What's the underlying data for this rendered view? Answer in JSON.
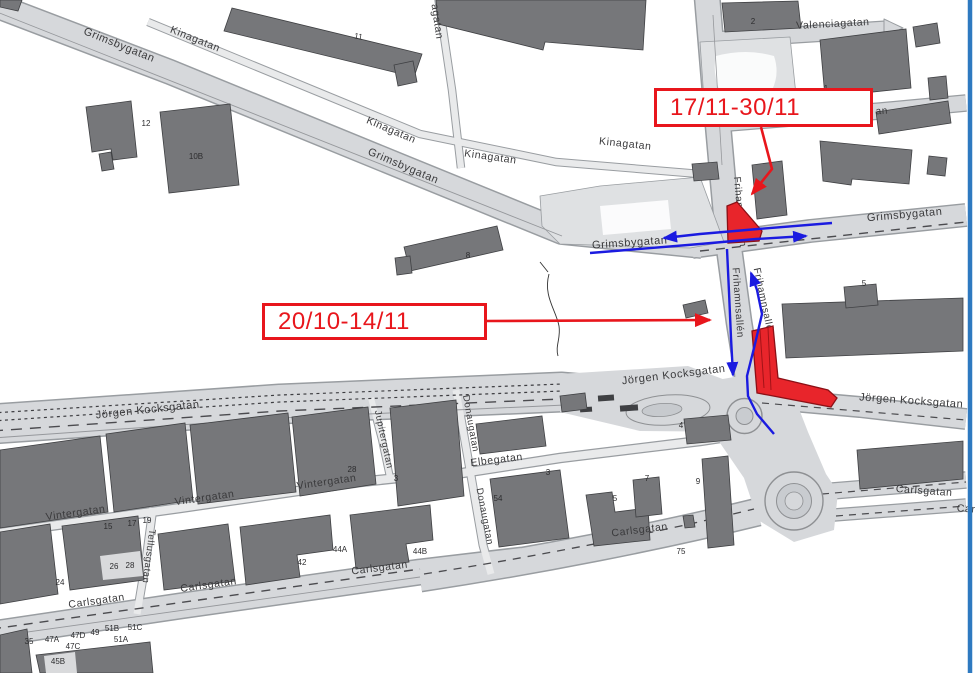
{
  "map": {
    "callouts": [
      {
        "id": "callout-1",
        "label": "17/11-30/11"
      },
      {
        "id": "callout-2",
        "label": "20/10-14/11"
      }
    ],
    "street_labels": [
      {
        "id": "grimsbygatan-nw",
        "text": "Grimsbygatan",
        "x": 118,
        "y": 48,
        "rot": 22,
        "size": 11
      },
      {
        "id": "kinagatan-nw",
        "text": "Kinagatan",
        "x": 194,
        "y": 42,
        "rot": 22,
        "size": 10.5
      },
      {
        "id": "kinagatan-mid",
        "text": "Kinagatan",
        "x": 390,
        "y": 133,
        "rot": 23,
        "size": 10.5
      },
      {
        "id": "grimsbygatan-mid",
        "text": "Grimsbygatan",
        "x": 402,
        "y": 169,
        "rot": 23,
        "size": 11
      },
      {
        "id": "kinagatan-c",
        "text": "Kinagatan",
        "x": 490,
        "y": 160,
        "rot": 8,
        "size": 10.5
      },
      {
        "id": "kinagatan-e",
        "text": "Kinagatan",
        "x": 625,
        "y": 147,
        "rot": 6,
        "size": 10.5
      },
      {
        "id": "valenciagatan",
        "text": "Valenciagatan",
        "x": 833,
        "y": 27,
        "rot": -3,
        "size": 10.5
      },
      {
        "id": "kinagatan-vert",
        "text": "agatan",
        "x": 434,
        "y": 22,
        "rot": 82,
        "size": 10.5
      },
      {
        "id": "grimsbygatan-ctr",
        "text": "Grimsbygatan",
        "x": 630,
        "y": 246,
        "rot": -4,
        "size": 11
      },
      {
        "id": "grimsbygatan-e",
        "text": "Grimsbygatan",
        "x": 905,
        "y": 218,
        "rot": -5,
        "size": 11
      },
      {
        "id": "frihamnsallen-n",
        "text": "Frihamnsallén",
        "x": 737,
        "y": 212,
        "rot": 85,
        "size": 10
      },
      {
        "id": "frihamnsallen-sw",
        "text": "Frihamnsallén",
        "x": 735,
        "y": 303,
        "rot": 86,
        "size": 10
      },
      {
        "id": "frihamnsallen-se",
        "text": "Frihamnsallén",
        "x": 761,
        "y": 303,
        "rot": 78,
        "size": 10
      },
      {
        "id": "jorgen-kocksgatan-w",
        "text": "Jörgen Kocksgatan",
        "x": 148,
        "y": 413,
        "rot": -6,
        "size": 11
      },
      {
        "id": "jorgen-kocksgatan-c",
        "text": "Jörgen Kocksgatan",
        "x": 674,
        "y": 378,
        "rot": -7,
        "size": 11
      },
      {
        "id": "jorgen-kocksgatan-e",
        "text": "Jörgen Kocksgatan",
        "x": 911,
        "y": 404,
        "rot": 4,
        "size": 11
      },
      {
        "id": "vintergatan-w",
        "text": "Vintergatan",
        "x": 76,
        "y": 516,
        "rot": -8,
        "size": 10.5
      },
      {
        "id": "vintergatan-c",
        "text": "Vintergatan",
        "x": 205,
        "y": 501,
        "rot": -8,
        "size": 10.5
      },
      {
        "id": "vintergatan-e",
        "text": "Vintergatan",
        "x": 327,
        "y": 485,
        "rot": -8,
        "size": 10.5
      },
      {
        "id": "tellusgatan",
        "text": "Tellusgatan",
        "x": 146,
        "y": 556,
        "rot": 97,
        "size": 9.5
      },
      {
        "id": "jupitergatan",
        "text": "Jupitergatan",
        "x": 381,
        "y": 440,
        "rot": 78,
        "size": 9.5
      },
      {
        "id": "donaugatan-n",
        "text": "Donaugatan",
        "x": 468,
        "y": 424,
        "rot": 80,
        "size": 9.5
      },
      {
        "id": "donaugatan-s",
        "text": "Donaugatan",
        "x": 482,
        "y": 517,
        "rot": 79,
        "size": 9.5
      },
      {
        "id": "elbegatan",
        "text": "Elbegatan",
        "x": 497,
        "y": 463,
        "rot": -7,
        "size": 10.5
      },
      {
        "id": "carlsgatan-w1",
        "text": "Carlsgatan",
        "x": 97,
        "y": 604,
        "rot": -8,
        "size": 10.5
      },
      {
        "id": "carlsgatan-w2",
        "text": "Carlsgatan",
        "x": 209,
        "y": 588,
        "rot": -8,
        "size": 10.5
      },
      {
        "id": "carlsgatan-w3",
        "text": "Carlsgatan",
        "x": 380,
        "y": 571,
        "rot": -7,
        "size": 10.5
      },
      {
        "id": "carlsgatan-c",
        "text": "Carlsgatan",
        "x": 640,
        "y": 533,
        "rot": -7,
        "size": 10.5
      },
      {
        "id": "carlsgatan-e",
        "text": "Carlsgatan",
        "x": 924,
        "y": 494,
        "rot": 4,
        "size": 10.5
      },
      {
        "id": "carlsgatan-e-frag",
        "text": "Car",
        "x": 966,
        "y": 512,
        "rot": 4,
        "size": 10.5
      },
      {
        "id": "street-frag-an",
        "text": "an",
        "x": 882,
        "y": 114,
        "rot": -4,
        "size": 10
      }
    ],
    "building_numbers": [
      {
        "text": "11",
        "x": 358,
        "y": 39,
        "rot": 10
      },
      {
        "text": "12",
        "x": 146,
        "y": 126
      },
      {
        "text": "10B",
        "x": 196,
        "y": 159
      },
      {
        "text": "2",
        "x": 753,
        "y": 24
      },
      {
        "text": "1",
        "x": 826,
        "y": 91
      },
      {
        "text": "8",
        "x": 468,
        "y": 258
      },
      {
        "text": "5",
        "x": 864,
        "y": 286
      },
      {
        "text": "4",
        "x": 681,
        "y": 428
      },
      {
        "text": "28",
        "x": 352,
        "y": 472
      },
      {
        "text": "3",
        "x": 396,
        "y": 481
      },
      {
        "text": "3",
        "x": 548,
        "y": 475
      },
      {
        "text": "54",
        "x": 498,
        "y": 501
      },
      {
        "text": "5",
        "x": 615,
        "y": 501
      },
      {
        "text": "7",
        "x": 647,
        "y": 481
      },
      {
        "text": "9",
        "x": 698,
        "y": 484
      },
      {
        "text": "75",
        "x": 681,
        "y": 554
      },
      {
        "text": "15",
        "x": 108,
        "y": 529
      },
      {
        "text": "17",
        "x": 132,
        "y": 526
      },
      {
        "text": "19",
        "x": 147,
        "y": 523
      },
      {
        "text": "24",
        "x": 60,
        "y": 585
      },
      {
        "text": "26",
        "x": 114,
        "y": 569
      },
      {
        "text": "28",
        "x": 130,
        "y": 568
      },
      {
        "text": "42",
        "x": 302,
        "y": 565
      },
      {
        "text": "44A",
        "x": 340,
        "y": 552
      },
      {
        "text": "44B",
        "x": 420,
        "y": 554
      },
      {
        "text": "35",
        "x": 29,
        "y": 644
      },
      {
        "text": "47A",
        "x": 52,
        "y": 642
      },
      {
        "text": "47D",
        "x": 78,
        "y": 638
      },
      {
        "text": "49",
        "x": 95,
        "y": 635
      },
      {
        "text": "51B",
        "x": 112,
        "y": 631
      },
      {
        "text": "51C",
        "x": 135,
        "y": 630
      },
      {
        "text": "47C",
        "x": 73,
        "y": 649
      },
      {
        "text": "51A",
        "x": 121,
        "y": 642
      },
      {
        "text": "45B",
        "x": 58,
        "y": 664
      }
    ],
    "colors": {
      "annotation_red": "#e8161c",
      "detour_blue": "#1b1be0",
      "road_fill": "#d6d8db",
      "road_outline": "#999da1",
      "building_fill": "#76777a",
      "edge_line_blue": "#2e79c0"
    }
  }
}
